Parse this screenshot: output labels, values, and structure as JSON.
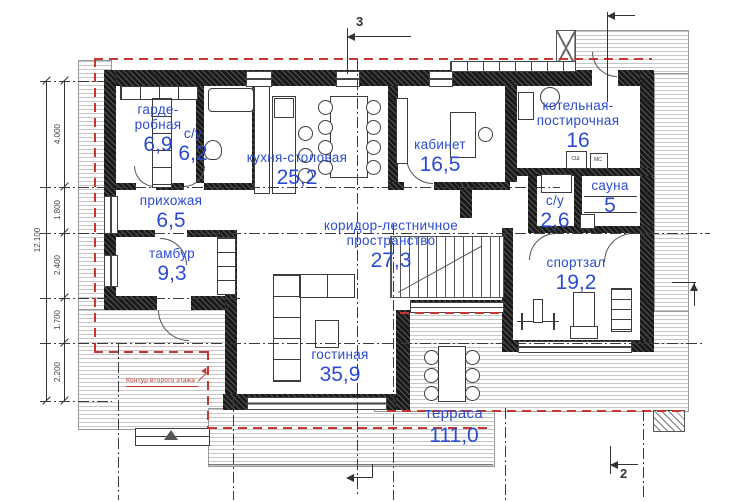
{
  "plan": {
    "rooms": [
      {
        "name": "гарде-",
        "name2": "робная",
        "area": "6,9"
      },
      {
        "name": "с/у",
        "area": "6,2"
      },
      {
        "name": "кухня-столовая",
        "area": "25,2"
      },
      {
        "name": "кабинет",
        "area": "16,5"
      },
      {
        "name": "котельная-",
        "name2": "постирочная",
        "area": "16"
      },
      {
        "name": "сауна",
        "area": "5"
      },
      {
        "name": "с/у",
        "area": "2,6"
      },
      {
        "name": "прихожая",
        "area": "6,5"
      },
      {
        "name": "коридор-лестничное пространство",
        "area": "27,3"
      },
      {
        "name": "тамбур",
        "area": "9,3"
      },
      {
        "name": "спортзал",
        "area": "19,2"
      },
      {
        "name": "гостиная",
        "area": "35,9"
      },
      {
        "name": "терраса",
        "area": "111,0"
      }
    ],
    "dimensions": {
      "segments": [
        "4.000",
        "1.800",
        "2.400",
        "1.700",
        "2.200"
      ],
      "total": "12.100"
    },
    "markers": {
      "section_top": "3",
      "section_bottom": "2"
    },
    "annotations": {
      "second_floor_contour": "Контур второго этажа"
    },
    "appliances": {
      "washer": "СШ",
      "dryer": "МС"
    },
    "colors": {
      "label_blue": "#2b4bd1",
      "contour_red": "#c8372f",
      "wall_black": "#1a1a1a"
    }
  }
}
